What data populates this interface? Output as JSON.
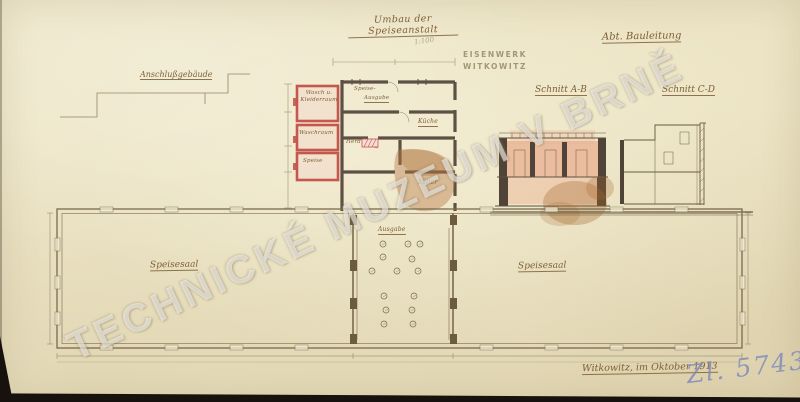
{
  "document": {
    "title": "Umbau der Speiseanstalt",
    "scale_note": "1:100",
    "stamp_line1": "EISENWERK",
    "stamp_line2": "WITKOWITZ",
    "department": "Abt. Bauleitung",
    "signature": "Witkowitz, im Oktober 1913",
    "archive_number": "Zl. 5743/12",
    "watermark": "TECHNICKÉ MUZEUM V BRNĚ"
  },
  "sections": {
    "ab_label": "Schnitt A-B",
    "cd_label": "Schnitt C-D"
  },
  "upper_plan": {
    "annex_label": "Anschlußgebäude",
    "room_labels": {
      "wash1": "Wasch u.",
      "wash2": "Kleiderraum",
      "waschraum": "Waschraum",
      "speise": "Speise",
      "ausgabe1": "Speise-",
      "ausgabe2": "Ausgabe",
      "kueche": "Küche",
      "herd": "Herd",
      "keller": "Keller"
    }
  },
  "lower_plan": {
    "left_hall_label": "Speisesaal",
    "right_hall_label": "Speisesaal",
    "serving_label": "Ausgabe"
  },
  "colors": {
    "paper": "#ece4c6",
    "ink": "#7a6a4e",
    "red_new_wall": "#c4574e",
    "wall_poche": "#5e5144",
    "section_wash": "#eab193",
    "stain": "#a5682f",
    "blue_pencil": "#7e8abc",
    "watermark_white": "rgba(255,255,255,0.55)"
  }
}
